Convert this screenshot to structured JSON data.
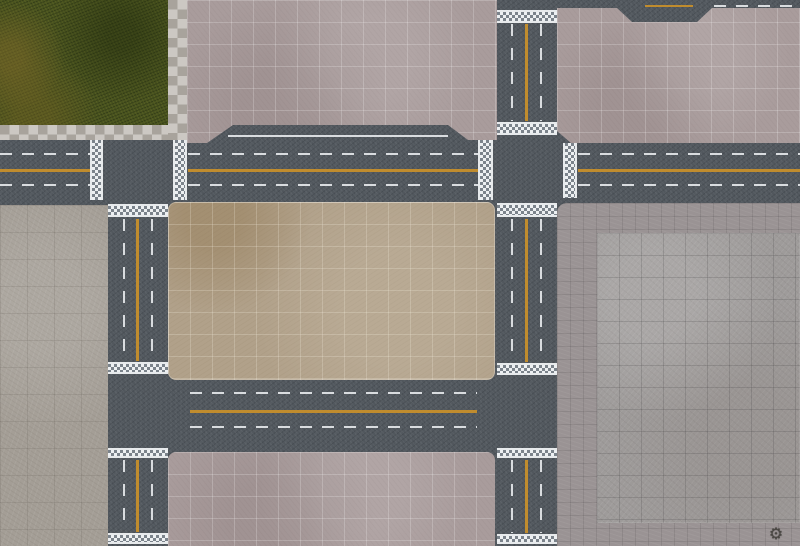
{
  "palette": {
    "asphalt": "#51575d",
    "grass": "#48521f",
    "pink": "#a99c9c",
    "tan": "#b1a18a",
    "grayblock": "#a49e96",
    "taupe": "#9a9394",
    "slab": "#9e9b9a",
    "curb_a": "#ccc8c3",
    "curb_b": "#a8a39c",
    "lane_white": "#d9dcdf",
    "lane_yellow": "#c08c2e",
    "crosswalk_light": "#edf0f2",
    "crosswalk_dark": "#7b838b"
  },
  "logo": {
    "glyph": "⚙"
  },
  "elements": [
    {
      "name": "grass-park-block",
      "cls": "grass",
      "x": 0,
      "y": 0,
      "w": 168,
      "h": 125
    },
    {
      "name": "curb-checker-vertical",
      "cls": "curb",
      "x": 168,
      "y": 0,
      "w": 19,
      "h": 140
    },
    {
      "name": "curb-checker-horizontal",
      "cls": "curb",
      "x": 0,
      "y": 125,
      "w": 168,
      "h": 15
    },
    {
      "name": "pavement-block-top-center",
      "cls": "block-pink",
      "x": 187,
      "y": 0,
      "w": 310,
      "h": 143,
      "clip": "polygon(0px 0px, 310px 0px, 310px 140px, 281px 140px, 261px 125px, 46px 125px, 20px 143px, 0px 143px)"
    },
    {
      "name": "pavement-block-top-right",
      "cls": "block-pink",
      "x": 557,
      "y": 0,
      "w": 243,
      "h": 143,
      "clip": "polygon(0px 8px, 60px 8px, 75px 22px, 140px 22px, 155px 8px, 243px 8px, 243px 143px, 14px 143px, 0px 131px)"
    },
    {
      "name": "concrete-block-left",
      "cls": "block-gray",
      "x": 0,
      "y": 205,
      "w": 108,
      "h": 341
    },
    {
      "name": "pavement-right-base",
      "cls": "block-taupe",
      "x": 557,
      "y": 203,
      "w": 243,
      "h": 343,
      "r": "10px 0 0 0"
    },
    {
      "name": "concrete-slab-right",
      "cls": "block-slab",
      "x": 597,
      "y": 233,
      "w": 203,
      "h": 290
    },
    {
      "name": "plaza-block-center",
      "cls": "block-tan",
      "x": 168,
      "y": 202,
      "w": 327,
      "h": 178,
      "r": "8px"
    },
    {
      "name": "pavement-block-bottom-center",
      "cls": "block-pink",
      "x": 168,
      "y": 452,
      "w": 327,
      "h": 94,
      "r": "8px 8px 0 0"
    },
    {
      "name": "road1-edge-line-wide-lane",
      "cls": "line-h",
      "x": 228,
      "y": 135,
      "w": 220,
      "h": 2
    },
    {
      "name": "road1-lane-dash-upper-west",
      "cls": "dash-h",
      "x": 0,
      "y": 153,
      "w": 90,
      "h": 2
    },
    {
      "name": "road1-lane-dash-upper-mid",
      "cls": "dash-h",
      "x": 188,
      "y": 153,
      "w": 290,
      "h": 2
    },
    {
      "name": "road1-lane-dash-upper-east",
      "cls": "dash-h",
      "x": 578,
      "y": 153,
      "w": 222,
      "h": 2
    },
    {
      "name": "road1-center-yellow-west",
      "cls": "yellow-h",
      "x": 0,
      "y": 169,
      "w": 90,
      "h": 3
    },
    {
      "name": "road1-center-yellow-mid",
      "cls": "yellow-h",
      "x": 188,
      "y": 169,
      "w": 290,
      "h": 3
    },
    {
      "name": "road1-center-yellow-east",
      "cls": "yellow-h",
      "x": 578,
      "y": 169,
      "w": 222,
      "h": 3
    },
    {
      "name": "road1-lane-dash-lower-west",
      "cls": "dash-h",
      "x": 0,
      "y": 184,
      "w": 90,
      "h": 2
    },
    {
      "name": "road1-lane-dash-lower-mid",
      "cls": "dash-h",
      "x": 188,
      "y": 184,
      "w": 290,
      "h": 2
    },
    {
      "name": "road1-lane-dash-lower-east",
      "cls": "dash-h",
      "x": 578,
      "y": 184,
      "w": 222,
      "h": 2
    },
    {
      "name": "road2-lane-dash-upper",
      "cls": "dash-h",
      "x": 190,
      "y": 392,
      "w": 287,
      "h": 2
    },
    {
      "name": "road2-center-yellow",
      "cls": "yellow-h",
      "x": 190,
      "y": 410,
      "w": 287,
      "h": 3
    },
    {
      "name": "road2-lane-dash-lower",
      "cls": "dash-h",
      "x": 190,
      "y": 426,
      "w": 287,
      "h": 2
    },
    {
      "name": "vroad1-dash-west-mid",
      "cls": "dash-v",
      "x": 123,
      "y": 219,
      "w": 2,
      "h": 142
    },
    {
      "name": "vroad1-yellow-mid",
      "cls": "yellow-v",
      "x": 136,
      "y": 219,
      "w": 3,
      "h": 142
    },
    {
      "name": "vroad1-dash-east-mid",
      "cls": "dash-v",
      "x": 151,
      "y": 219,
      "w": 2,
      "h": 142
    },
    {
      "name": "vroad1-dash-west-low",
      "cls": "dash-v",
      "x": 123,
      "y": 460,
      "w": 2,
      "h": 72
    },
    {
      "name": "vroad1-yellow-low",
      "cls": "yellow-v",
      "x": 136,
      "y": 460,
      "w": 3,
      "h": 72
    },
    {
      "name": "vroad1-dash-east-low",
      "cls": "dash-v",
      "x": 151,
      "y": 460,
      "w": 2,
      "h": 72
    },
    {
      "name": "vroad2-dash-west-top",
      "cls": "dash-v",
      "x": 511,
      "y": 24,
      "w": 2,
      "h": 97
    },
    {
      "name": "vroad2-yellow-top",
      "cls": "yellow-v",
      "x": 525,
      "y": 24,
      "w": 3,
      "h": 97
    },
    {
      "name": "vroad2-dash-east-top",
      "cls": "dash-v",
      "x": 540,
      "y": 24,
      "w": 2,
      "h": 97
    },
    {
      "name": "vroad2-dash-west-mid",
      "cls": "dash-v",
      "x": 511,
      "y": 219,
      "w": 2,
      "h": 143
    },
    {
      "name": "vroad2-yellow-mid",
      "cls": "yellow-v",
      "x": 525,
      "y": 219,
      "w": 3,
      "h": 143
    },
    {
      "name": "vroad2-dash-east-mid",
      "cls": "dash-v",
      "x": 540,
      "y": 219,
      "w": 2,
      "h": 143
    },
    {
      "name": "vroad2-dash-west-low",
      "cls": "dash-v",
      "x": 511,
      "y": 460,
      "w": 2,
      "h": 73
    },
    {
      "name": "vroad2-yellow-low",
      "cls": "yellow-v",
      "x": 525,
      "y": 460,
      "w": 3,
      "h": 73
    },
    {
      "name": "vroad2-dash-east-low",
      "cls": "dash-v",
      "x": 540,
      "y": 460,
      "w": 2,
      "h": 73
    },
    {
      "name": "top-road-yellow-segment",
      "cls": "yellow-h",
      "x": 645,
      "y": 5,
      "w": 48,
      "h": 2
    },
    {
      "name": "top-road-dash-segment",
      "cls": "dash-h",
      "x": 714,
      "y": 5,
      "w": 82,
      "h": 2
    },
    {
      "name": "crosswalk-road1-t1-west",
      "cls": "cw-v",
      "x": 90,
      "y": 140,
      "w": 13,
      "h": 60
    },
    {
      "name": "crosswalk-road1-t1-east",
      "cls": "cw-v",
      "x": 173,
      "y": 140,
      "w": 14,
      "h": 60
    },
    {
      "name": "crosswalk-road1-x1-west",
      "cls": "cw-v",
      "x": 478,
      "y": 140,
      "w": 15,
      "h": 60
    },
    {
      "name": "crosswalk-road1-x1-east",
      "cls": "cw-v",
      "x": 563,
      "y": 143,
      "w": 14,
      "h": 55
    },
    {
      "name": "crosswalk-vroad2-top-edge",
      "cls": "cw-h",
      "x": 497,
      "y": 10,
      "w": 60,
      "h": 13
    },
    {
      "name": "crosswalk-vroad2-x1-north",
      "cls": "cw-h",
      "x": 497,
      "y": 122,
      "w": 60,
      "h": 13
    },
    {
      "name": "crosswalk-vroad2-x1-south",
      "cls": "cw-h",
      "x": 497,
      "y": 203,
      "w": 60,
      "h": 14
    },
    {
      "name": "crosswalk-vroad1-t1-south",
      "cls": "cw-h",
      "x": 108,
      "y": 204,
      "w": 60,
      "h": 13
    },
    {
      "name": "crosswalk-vroad1-t2-north",
      "cls": "cw-h",
      "x": 108,
      "y": 362,
      "w": 60,
      "h": 12
    },
    {
      "name": "crosswalk-vroad2-t3-north",
      "cls": "cw-h",
      "x": 497,
      "y": 363,
      "w": 60,
      "h": 12
    },
    {
      "name": "crosswalk-vroad1-t2-south",
      "cls": "cw-h",
      "x": 108,
      "y": 448,
      "w": 60,
      "h": 10
    },
    {
      "name": "crosswalk-vroad2-t3-south",
      "cls": "cw-h",
      "x": 497,
      "y": 448,
      "w": 60,
      "h": 10
    },
    {
      "name": "crosswalk-vroad1-bottom-edge",
      "cls": "cw-h",
      "x": 108,
      "y": 533,
      "w": 60,
      "h": 11
    },
    {
      "name": "crosswalk-vroad2-bottom-edge",
      "cls": "cw-h",
      "x": 497,
      "y": 534,
      "w": 60,
      "h": 10
    }
  ]
}
